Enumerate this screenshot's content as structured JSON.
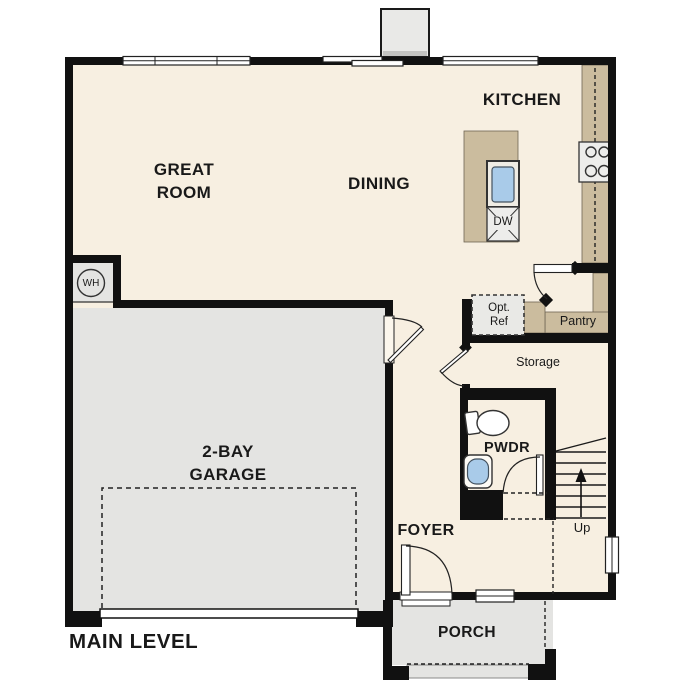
{
  "plan_title": "MAIN LEVEL",
  "rooms": {
    "great_room": "GREAT ROOM",
    "dining": "DINING",
    "kitchen": "KITCHEN",
    "garage": "2-BAY GARAGE",
    "foyer": "FOYER",
    "powder_room": "PWDR",
    "porch": "PORCH",
    "storage": "Storage",
    "pantry": "Pantry"
  },
  "fixtures": {
    "water_heater_abbr": "WH",
    "dishwasher_abbr": "DW",
    "optional_refrigerator": [
      "Opt.",
      "Ref"
    ],
    "stair_direction": "Up"
  },
  "colors": {
    "wall": "#111111",
    "floor": "#f7efe1",
    "concrete": "#e4e4e2",
    "counter": "#cbbc9e",
    "fixture_blue": "#a9cbe9",
    "chimney": "#e9e9e7",
    "optional_item_fill": "#e9e9e6",
    "appliance_fill": "#ededeb"
  }
}
